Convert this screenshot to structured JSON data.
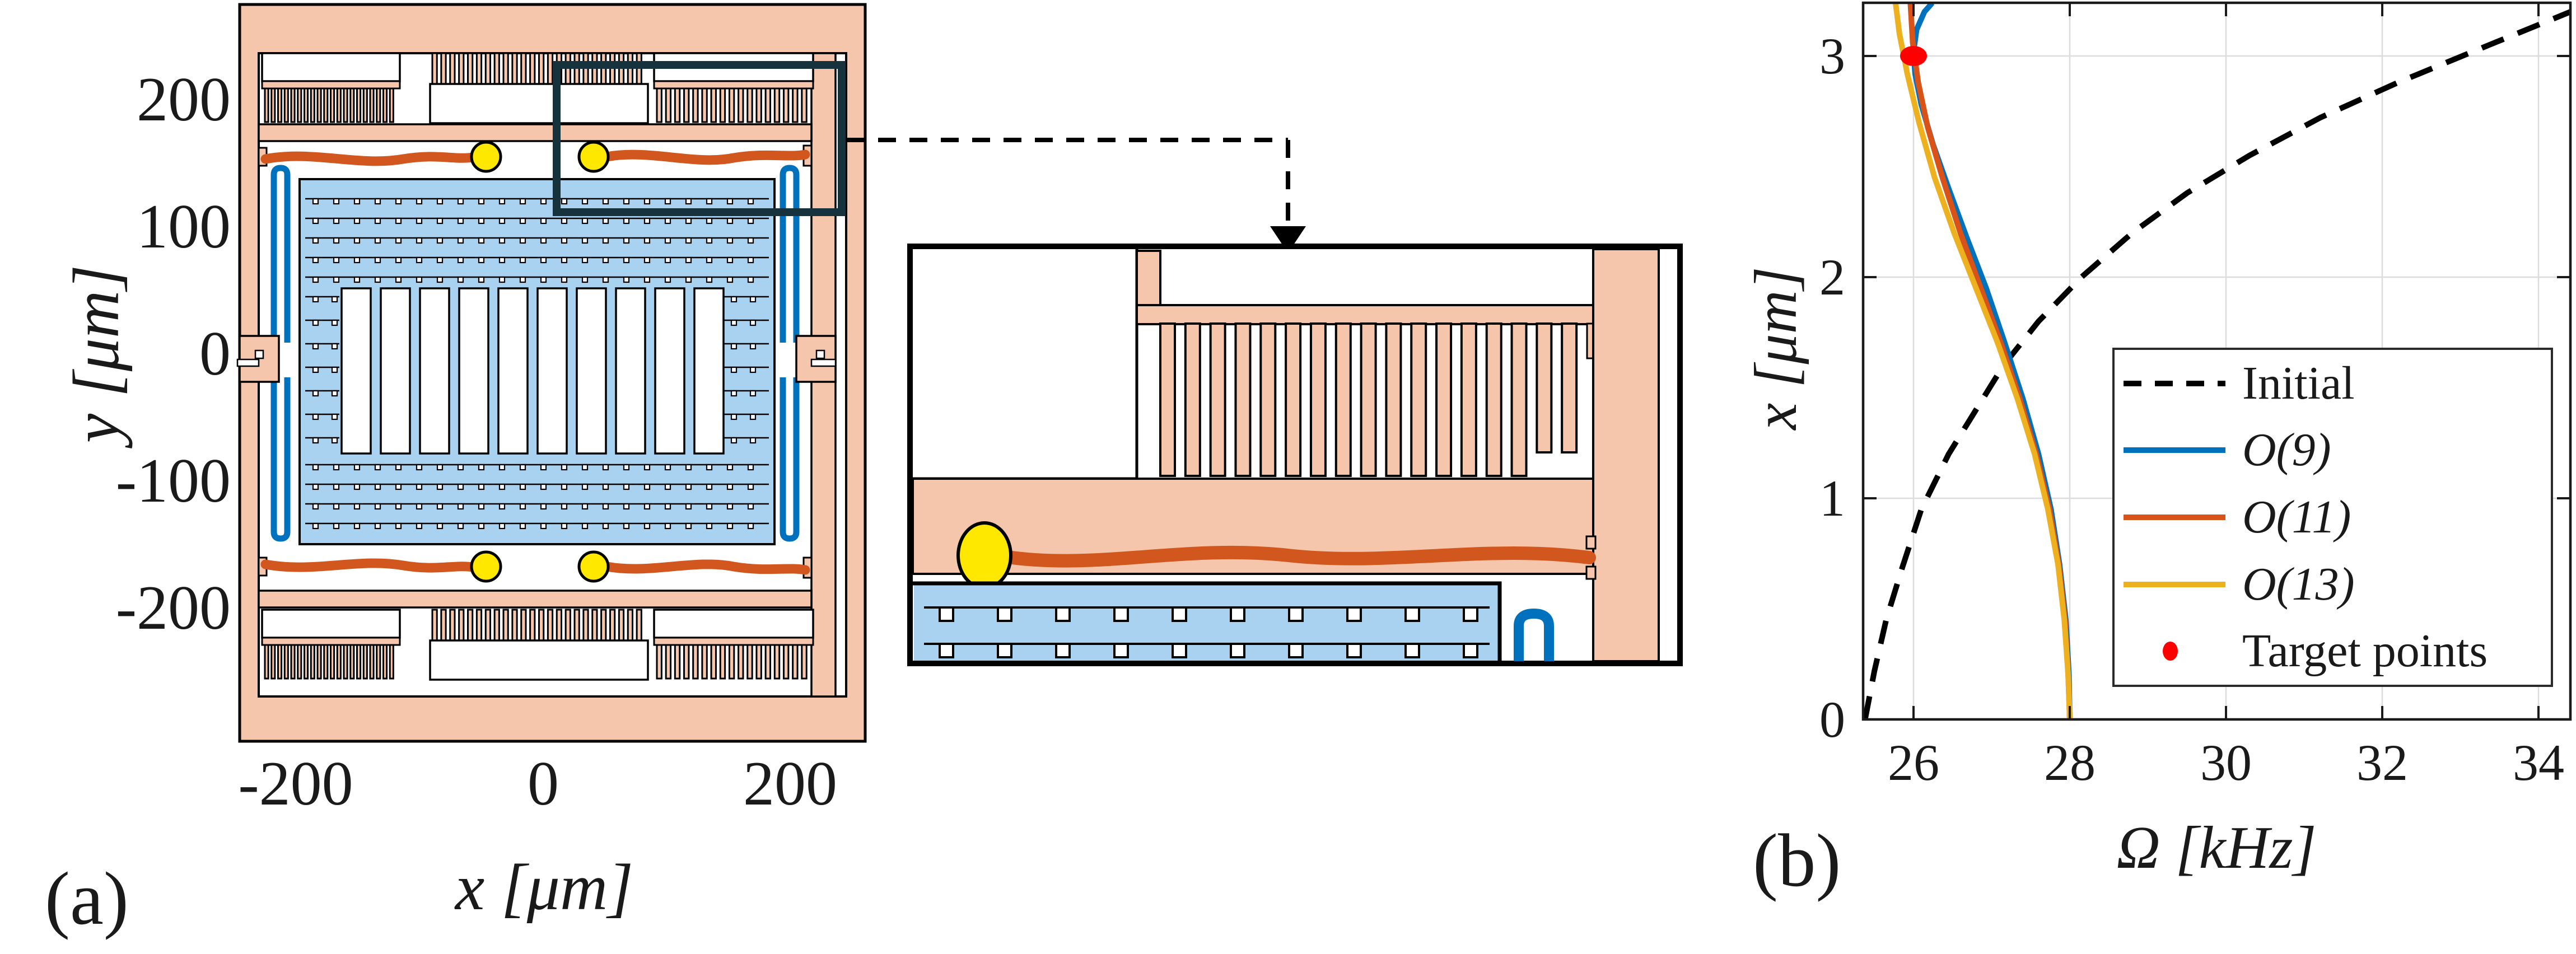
{
  "figure_colors": {
    "anchor_pink": "#F5C6AB",
    "plate_blue": "#A8D2F0",
    "spring_blue": "#0072BD",
    "coupler_orange": "#D2571E",
    "bead_yellow": "#FFE800",
    "zoom_box_dark": "#16323D",
    "grid_gray": "#DCDCDC",
    "spine_black": "#1a1a1a",
    "target_red": "#FF0000"
  },
  "panel_a": {
    "label": "(a)",
    "x_axis": {
      "label": "x [μm]",
      "ticks": [
        "-200",
        "0",
        "200"
      ]
    },
    "y_axis": {
      "label": "y [μm]",
      "ticks": [
        "200",
        "100",
        "0",
        "-100",
        "-200"
      ]
    }
  },
  "panel_b": {
    "label": "(b)"
  },
  "chart_data": {
    "type": "line",
    "title": "",
    "xlabel": "Ω [kHz]",
    "ylabel": "x [μm]",
    "xlim": [
      25.35,
      34.41
    ],
    "ylim": [
      0,
      3.24
    ],
    "xticks": [
      "26",
      "28",
      "30",
      "32",
      "34"
    ],
    "yticks": [
      "0",
      "1",
      "2",
      "3"
    ],
    "grid": true,
    "legend_position": "middle-right",
    "series": [
      {
        "name": "Initial",
        "color": "#000000",
        "style": "dashed",
        "math": false,
        "points": [
          [
            25.38,
            0
          ],
          [
            25.5,
            0.22
          ],
          [
            25.65,
            0.45
          ],
          [
            25.85,
            0.68
          ],
          [
            26.1,
            0.95
          ],
          [
            26.45,
            1.2
          ],
          [
            26.8,
            1.4
          ],
          [
            27.15,
            1.6
          ],
          [
            27.6,
            1.8
          ],
          [
            28.15,
            2.0
          ],
          [
            28.8,
            2.2
          ],
          [
            29.5,
            2.38
          ],
          [
            30.3,
            2.55
          ],
          [
            31.2,
            2.72
          ],
          [
            32.2,
            2.88
          ],
          [
            33.3,
            3.04
          ],
          [
            34.41,
            3.2
          ]
        ]
      },
      {
        "name": "O(9)",
        "color": "#0072BD",
        "style": "solid",
        "math": true,
        "points": [
          [
            28.0,
            0
          ],
          [
            27.99,
            0.2
          ],
          [
            27.95,
            0.45
          ],
          [
            27.87,
            0.7
          ],
          [
            27.76,
            0.95
          ],
          [
            27.6,
            1.2
          ],
          [
            27.4,
            1.45
          ],
          [
            27.17,
            1.7
          ],
          [
            26.93,
            1.95
          ],
          [
            26.68,
            2.18
          ],
          [
            26.45,
            2.4
          ],
          [
            26.25,
            2.6
          ],
          [
            26.1,
            2.78
          ],
          [
            26.02,
            2.92
          ],
          [
            26.0,
            3.02
          ],
          [
            26.04,
            3.12
          ],
          [
            26.14,
            3.2
          ],
          [
            26.24,
            3.24
          ]
        ]
      },
      {
        "name": "O(11)",
        "color": "#D95319",
        "style": "solid",
        "math": true,
        "points": [
          [
            28.0,
            0
          ],
          [
            27.98,
            0.2
          ],
          [
            27.94,
            0.45
          ],
          [
            27.86,
            0.7
          ],
          [
            27.74,
            0.95
          ],
          [
            27.57,
            1.2
          ],
          [
            27.36,
            1.45
          ],
          [
            27.12,
            1.7
          ],
          [
            26.86,
            1.95
          ],
          [
            26.6,
            2.2
          ],
          [
            26.37,
            2.45
          ],
          [
            26.18,
            2.68
          ],
          [
            26.06,
            2.88
          ],
          [
            25.99,
            3.06
          ],
          [
            25.96,
            3.24
          ]
        ]
      },
      {
        "name": "O(13)",
        "color": "#EDB120",
        "style": "solid",
        "math": true,
        "points": [
          [
            28.0,
            0
          ],
          [
            27.98,
            0.2
          ],
          [
            27.93,
            0.45
          ],
          [
            27.85,
            0.7
          ],
          [
            27.72,
            0.95
          ],
          [
            27.55,
            1.2
          ],
          [
            27.33,
            1.45
          ],
          [
            27.08,
            1.7
          ],
          [
            26.8,
            1.95
          ],
          [
            26.52,
            2.2
          ],
          [
            26.27,
            2.45
          ],
          [
            26.07,
            2.7
          ],
          [
            25.92,
            2.92
          ],
          [
            25.82,
            3.1
          ],
          [
            25.77,
            3.24
          ]
        ]
      },
      {
        "name": "Target points",
        "color": "#FF0000",
        "style": "marker",
        "math": false,
        "points": [
          [
            26.0,
            3.0
          ]
        ]
      }
    ]
  }
}
